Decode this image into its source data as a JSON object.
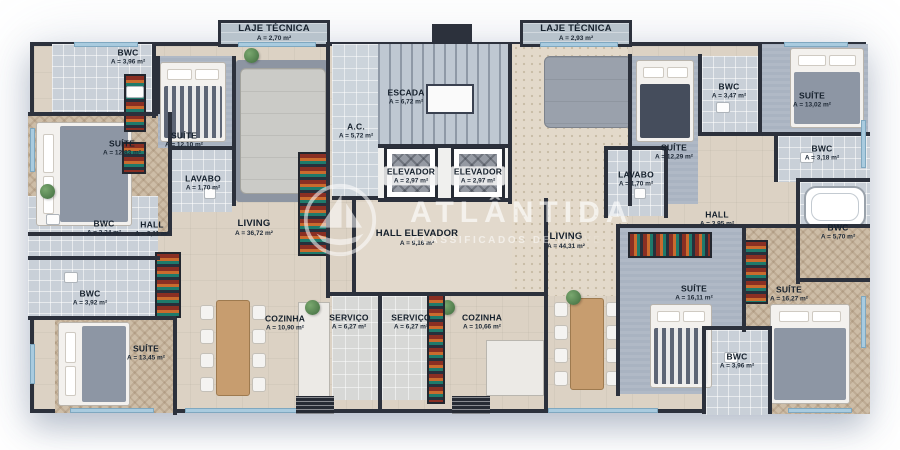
{
  "watermark": {
    "brand": "ATLÂNTIDA",
    "subtitle": "CLASSIFICADOS DE IMÓVEIS",
    "logo": "sailboat-icon",
    "color": "#ffffff"
  },
  "palette": {
    "wall": "#2c313c",
    "floor_beige": "#dcd2c4",
    "floor_bath": "#c9d0d8",
    "window_blue": "#a9cbdf"
  },
  "rooms": [
    {
      "name": "BWC",
      "area": "A = 3,96 m²"
    },
    {
      "name": "SUÍTE",
      "area": "A = 12,83 m²"
    },
    {
      "name": "SUÍTE",
      "area": "A = 12,10 m²"
    },
    {
      "name": "LAJE TÉCNICA",
      "area": "A = 2,70 m²"
    },
    {
      "name": "LAVABO",
      "area": "A = 1,70 m²"
    },
    {
      "name": "BWC",
      "area": "A = 3,24 m²"
    },
    {
      "name": "HALL",
      "area": "A = 2,11 m²"
    },
    {
      "name": "LIVING",
      "area": "A = 36,72 m²"
    },
    {
      "name": "BWC",
      "area": "A = 3,92 m²"
    },
    {
      "name": "SUÍTE",
      "area": "A = 13,45 m²"
    },
    {
      "name": "COZINHA",
      "area": "A = 10,90 m²"
    },
    {
      "name": "SERVIÇO",
      "area": "A = 6,27 m²"
    },
    {
      "name": "ESCADA",
      "area": "A = 6,72 m²"
    },
    {
      "name": "A.C.",
      "area": "A = 5,72 m²"
    },
    {
      "name": "ELEVADOR",
      "area": "A = 2,97 m²"
    },
    {
      "name": "ELEVADOR",
      "area": "A = 2,97 m²"
    },
    {
      "name": "HALL ELEVADOR",
      "area": "A = 9,16 m²"
    },
    {
      "name": "SERVIÇO",
      "area": "A = 6,27 m²"
    },
    {
      "name": "COZINHA",
      "area": "A = 10,66 m²"
    },
    {
      "name": "LAJE TÉCNICA",
      "area": "A = 2,93 m²"
    },
    {
      "name": "LIVING",
      "area": "A = 44,31 m²"
    },
    {
      "name": "SUÍTE",
      "area": "A = 12,29 m²"
    },
    {
      "name": "BWC",
      "area": "A = 3,47 m²"
    },
    {
      "name": "SUÍTE",
      "area": "A = 13,02 m²"
    },
    {
      "name": "BWC",
      "area": "A = 3,18 m²"
    },
    {
      "name": "LAVABO",
      "area": "A = 1,70 m²"
    },
    {
      "name": "HALL",
      "area": "A = 3,95 m²"
    },
    {
      "name": "BWC",
      "area": "A = 5,70 m²"
    },
    {
      "name": "SUÍTE",
      "area": "A = 16,11 m²"
    },
    {
      "name": "SUÍTE",
      "area": "A = 16,27 m²"
    },
    {
      "name": "BWC",
      "area": "A = 3,96 m²"
    }
  ]
}
